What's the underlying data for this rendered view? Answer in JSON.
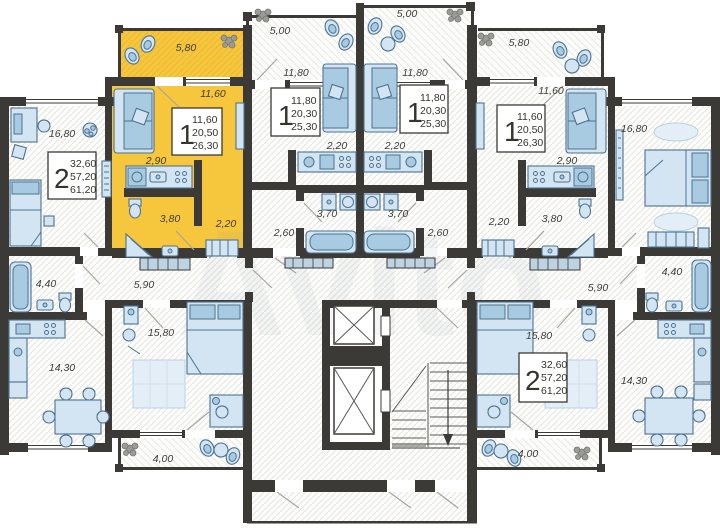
{
  "watermark": "Avito",
  "colors": {
    "highlight": "#f6c63c",
    "wall": "#3b3a36",
    "furniture_fill": "#d3e5f2",
    "furniture_stroke": "#4d7390"
  },
  "apartments": {
    "left_2room": {
      "rooms_count": "2",
      "living_area": "32,60",
      "floor_area": "57,20",
      "total_area": "61,20",
      "dims": {
        "bedroom1": "16,80",
        "bathroom": "4,40",
        "hallway": "5,90",
        "kitchen_living": "14,30",
        "bedroom2": "15,80",
        "balcony": "4,00"
      }
    },
    "highlighted_1room": {
      "rooms_count": "1",
      "living_area": "11,60",
      "floor_area": "20,50",
      "total_area": "26,30",
      "dims": {
        "balcony": "5,80",
        "living": "11,60",
        "kitchen": "2,90",
        "bathroom": "3,80",
        "hallway": "2,20"
      }
    },
    "mid_left_1room": {
      "rooms_count": "1",
      "living_area": "11,80",
      "floor_area": "20,30",
      "total_area": "25,30",
      "dims": {
        "balcony": "5,00",
        "living": "11,80",
        "kitchen": "2,20",
        "bathroom": "3,70",
        "hallway": "2,60"
      }
    },
    "mid_right_1room": {
      "rooms_count": "1",
      "living_area": "11,80",
      "floor_area": "20,30",
      "total_area": "25,30",
      "dims": {
        "balcony": "5,00",
        "living": "11,80",
        "kitchen": "2,20",
        "bathroom": "3,70",
        "hallway": "2,60"
      }
    },
    "right_1room": {
      "rooms_count": "1",
      "living_area": "11,60",
      "floor_area": "20,50",
      "total_area": "26,30",
      "dims": {
        "balcony": "5,80",
        "living": "11,60",
        "kitchen": "2,90",
        "bathroom": "3,80",
        "hallway": "2,20"
      }
    },
    "right_2room": {
      "rooms_count": "2",
      "living_area": "32,60",
      "floor_area": "57,20",
      "total_area": "61,20",
      "dims": {
        "bedroom1": "16,80",
        "bathroom": "4,40",
        "hallway": "5,90",
        "kitchen_living": "14,30",
        "bedroom2": "15,80",
        "balcony": "4,00"
      }
    }
  }
}
